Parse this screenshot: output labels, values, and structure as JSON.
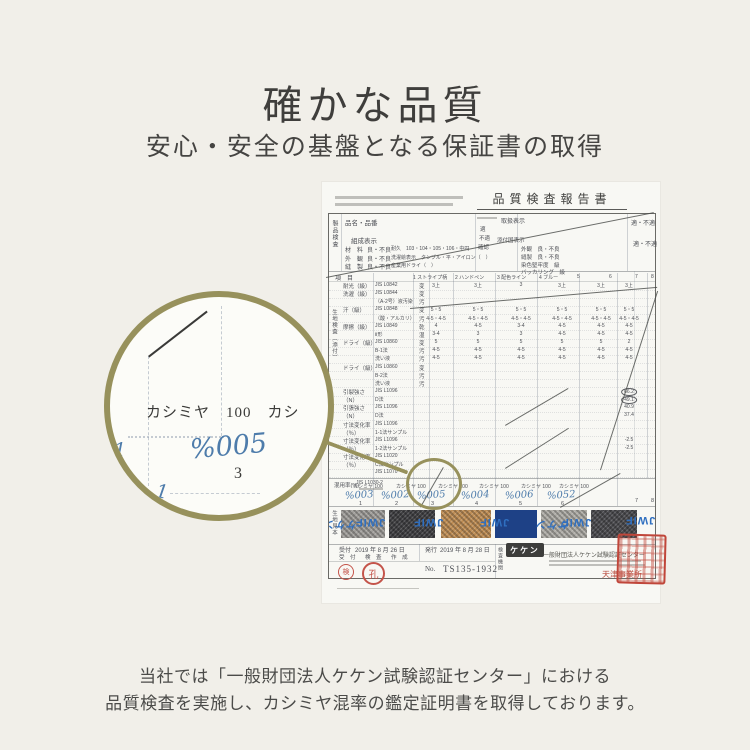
{
  "page_bg": "#f1efe9",
  "accent_olive": "#97915c",
  "hand_blue": "#4e7cab",
  "stamp_red": "#c0463a",
  "header": {
    "title": "確かな品質",
    "subtitle": "安心・安全の基盤となる保証書の取得"
  },
  "footer_note": {
    "line1": "当社では「一般財団法人ケケン試験認証センター」における",
    "line2": "品質検査を実施し、カシミヤ混率の鑑定証明書を取得しております。"
  },
  "magnifier": {
    "fiber_line": "カシミヤ　100　カシ",
    "hand_code": "%005",
    "column_no": "3",
    "mark_left": "1",
    "mark_lower": "1"
  },
  "certificate": {
    "doc_title": "品質検査報告書",
    "top": {
      "product_vertical": "製品検査",
      "product_label": "品名・品番",
      "composition_label": "組成表示",
      "rows": [
        {
          "name": "材　料",
          "grade": "良・不良",
          "extra": "耐久　103・104・105・106・中円"
        },
        {
          "name": "外　観",
          "grade": "良・不良",
          "extra": "洗濯絵表示　タンブル・平・アイロン（　）"
        },
        {
          "name": "縫　製",
          "grade": "良・不良",
          "extra": "産業用ドライ（　）"
        }
      ],
      "handling_label": "取扱表示",
      "handling_options": [
        "適",
        "不適",
        "確認"
      ],
      "attached_label": "添付国表示",
      "right_rows": [
        "外観　良・不良",
        "縫製　良・不良",
        "染色堅牢度　級",
        "バッカリング　級"
      ],
      "pass_top": "適・不適",
      "pass_second": "適・不適"
    },
    "table": {
      "item_label": "項　目",
      "fabric_vertical": "生地検査（添付）",
      "columns": [
        "1 ストライプ柄",
        "2 ハンドペン",
        "3 配色ライン",
        "4 ブルー",
        "5",
        "6",
        "7",
        "8"
      ],
      "rows": [
        {
          "label": "耐光（級）",
          "method": "JIS L0842",
          "sub": "変",
          "values": [
            "3上",
            "3上",
            "3",
            "3上",
            "3上",
            "3上"
          ],
          "circled": false
        },
        {
          "label": "洗濯（級）",
          "method": "JIS L0844",
          "sub": "変",
          "values": [
            "",
            "",
            "",
            "",
            "",
            ""
          ],
          "circled": false
        },
        {
          "label": "",
          "method": "（A-2号）液汚染",
          "sub": "汚",
          "values": [
            "",
            "",
            "",
            "",
            "",
            ""
          ],
          "circled": false
        },
        {
          "label": "汗（級）",
          "method": "JIS L0848",
          "sub": "変",
          "values": [
            "5・5",
            "5・5",
            "5・5",
            "5・5",
            "5・5",
            "5・5"
          ],
          "circled": false
        },
        {
          "label": "",
          "method": "（酸・アルカリ）",
          "sub": "汚",
          "values": [
            "4-5・4-5",
            "4-5・4-5",
            "4-5・4-5",
            "4-5・4-5",
            "4-5・4-5",
            "4-5・4-5"
          ],
          "circled": false
        },
        {
          "label": "摩擦（級）",
          "method": "JIS L0849",
          "sub": "乾",
          "values": [
            "4",
            "4-5",
            "3-4",
            "4-5",
            "4-5",
            "4-5"
          ],
          "circled": false
        },
        {
          "label": "",
          "method": "Ⅱ形",
          "sub": "湿",
          "values": [
            "3-4",
            "3",
            "3",
            "4-5",
            "4-5",
            "4-5"
          ],
          "circled": false
        },
        {
          "label": "ドライ（級）",
          "method": "JIS L0860",
          "sub": "変",
          "values": [
            "5",
            "5",
            "5",
            "5",
            "5",
            "2"
          ],
          "circled": false
        },
        {
          "label": "",
          "method": "B-1法",
          "sub": "汚",
          "values": [
            "4-5",
            "4-5",
            "4-5",
            "4-5",
            "4-5",
            "4-5"
          ],
          "circled": false
        },
        {
          "label": "",
          "method": "洗い液",
          "sub": "汚",
          "values": [
            "4-5",
            "4-5",
            "4-5",
            "4-5",
            "4-5",
            "4-5"
          ],
          "circled": false
        },
        {
          "label": "ドライ（級）",
          "method": "JIS L0860",
          "sub": "変",
          "values": [
            "",
            "",
            "",
            "",
            "",
            ""
          ],
          "circled": false
        },
        {
          "label": "",
          "method": "B-2法",
          "sub": "汚",
          "values": [
            "",
            "",
            "",
            "",
            "",
            ""
          ],
          "circled": false
        },
        {
          "label": "",
          "method": "洗い液",
          "sub": "汚",
          "values": [
            "",
            "",
            "",
            "",
            "",
            ""
          ],
          "circled": false
        },
        {
          "label": "引裂強さ",
          "method": "JIS L1096",
          "sub": "",
          "values": [
            "",
            "",
            "",
            "",
            "",
            "66.2"
          ],
          "circled": true
        },
        {
          "label": "（N）",
          "method": "D法",
          "sub": "",
          "values": [
            "",
            "",
            "",
            "",
            "",
            "49.1"
          ],
          "circled": true
        },
        {
          "label": "引張強さ",
          "method": "JIS L1096",
          "sub": "",
          "values": [
            "",
            "",
            "",
            "",
            "",
            "40.9"
          ],
          "circled": false
        },
        {
          "label": "（N）",
          "method": "D法",
          "sub": "",
          "values": [
            "",
            "",
            "",
            "",
            "",
            "37.4"
          ],
          "circled": false
        },
        {
          "label": "寸法変化率",
          "method": "JIS L1096",
          "sub": "",
          "values": [
            "",
            "",
            "",
            "",
            "",
            ""
          ],
          "circled": false
        },
        {
          "label": "（％）",
          "method": "1-1法サンプル",
          "sub": "",
          "values": [
            "",
            "",
            "",
            "",
            "",
            ""
          ],
          "circled": false
        },
        {
          "label": "寸法変化率",
          "method": "JIS L1096",
          "sub": "",
          "values": [
            "",
            "",
            "",
            "",
            "",
            "-2.5"
          ],
          "circled": false
        },
        {
          "label": "（％）",
          "method": "1-2法サンプル",
          "sub": "",
          "values": [
            "",
            "",
            "",
            "",
            "",
            "-2.5"
          ],
          "circled": false
        },
        {
          "label": "寸法変化率",
          "method": "JIS L1020",
          "sub": "",
          "values": [
            "",
            "",
            "",
            "",
            "",
            ""
          ],
          "circled": false
        },
        {
          "label": "（％）",
          "method": "C法サンプル",
          "sub": "",
          "values": [
            "",
            "",
            "",
            "",
            "",
            ""
          ],
          "circled": false
        },
        {
          "label": "",
          "method": "JIS L1070",
          "sub": "",
          "values": [
            "",
            "",
            "",
            "",
            "",
            ""
          ],
          "circled": false
        }
      ]
    },
    "mix": {
      "label": "混用率(%)",
      "method": "JIS L1030-2",
      "printed_values": [
        "カシミヤ 100",
        "カシミヤ 100",
        "カシミヤ 100",
        "カシミヤ 100",
        "カシミヤ 100",
        "カシミヤ 100"
      ],
      "hand_codes": [
        "%003",
        "%002",
        "%005",
        "%004",
        "%006",
        "%052"
      ],
      "sample_nums": [
        "1",
        "2",
        "3",
        "4",
        "5",
        "6"
      ],
      "extra_cols": [
        "7",
        "8"
      ]
    },
    "swatches": {
      "side_vertical": "生地見本",
      "jwif": "JWIF",
      "keken_text": "ケケン",
      "blocks": [
        {
          "color": "#a09e9a",
          "noisy": true
        },
        {
          "color": "#3f3f42",
          "noisy": true
        },
        {
          "color": "#bf8e55",
          "noisy": true
        },
        {
          "color": "#1e4186",
          "noisy": false
        },
        {
          "color": "#aeaca6",
          "noisy": true
        },
        {
          "color": "#4a4a4e",
          "noisy": true
        }
      ]
    },
    "footerblock": {
      "receipt_label": "受付",
      "receipt_date": "2019 年 8 月 26 日",
      "issue_label": "発行",
      "issue_date": "2019 年 8 月 28 日",
      "process_row": "受 付　検 査　作 成",
      "no_label": "No.",
      "no_value": "TS135-1932",
      "agency_vertical": "検査機関",
      "keken_logo": "ケケン",
      "org_name": "一般財団法人ケケン試験認証センター",
      "branch": "天津事業所",
      "stamp1": "検",
      "stamp2": "孔"
    }
  }
}
